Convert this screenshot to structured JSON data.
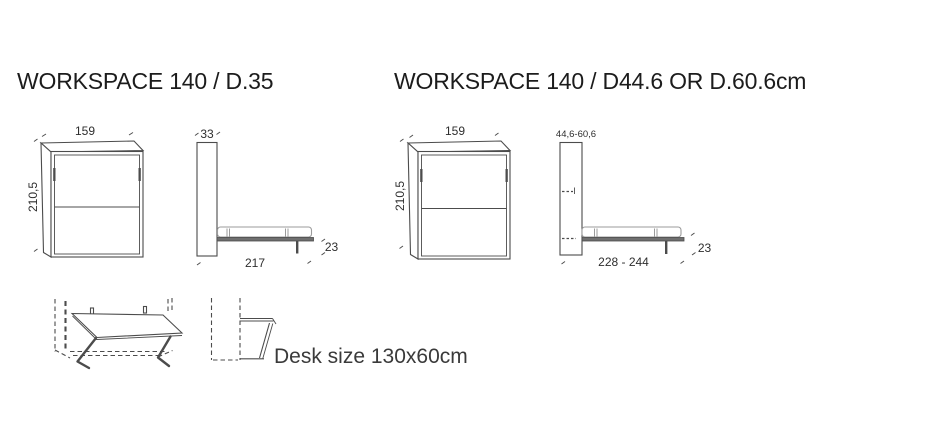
{
  "sections": {
    "left": {
      "title": "WORKSPACE 140 / D.35",
      "front": {
        "width": "159",
        "height": "210,5"
      },
      "side": {
        "depth": "33",
        "length": "217",
        "bed_height": "23"
      }
    },
    "right": {
      "title": "WORKSPACE 140 / D44.6 OR D.60.6cm",
      "front": {
        "width": "159",
        "height": "210,5"
      },
      "side": {
        "depth": "44,6-60,6",
        "length": "228 - 244",
        "bed_height": "23"
      }
    },
    "desk": {
      "caption": "Desk size 130x60cm"
    }
  },
  "colors": {
    "line": "#4c4c4c",
    "light_line": "#9b9b9b",
    "platform_fill": "#6f6f6f",
    "text": "#2e2e2e",
    "title_text": "#1c1c1c"
  }
}
